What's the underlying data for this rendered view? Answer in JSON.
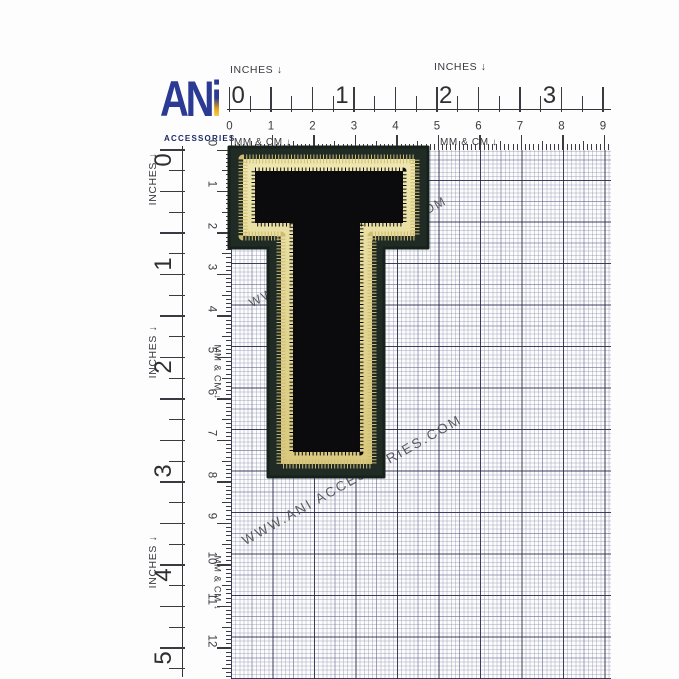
{
  "logo": {
    "an": "AN",
    "i": "i",
    "subtitle": "ACCESSORIES",
    "blue": "#2b3a92",
    "gold": "#f2b21d"
  },
  "rulers": {
    "inches_label": "INCHES ↓",
    "mmcm_label": "MM & CM ↓",
    "top": {
      "inch_numbers": [
        "0",
        "1",
        "2",
        "3"
      ],
      "cm_numbers": [
        "0",
        "1",
        "2",
        "3",
        "4",
        "5",
        "6",
        "7",
        "8",
        "9"
      ]
    },
    "left": {
      "inch_numbers": [
        "0",
        "1",
        "2",
        "3",
        "4",
        "5"
      ],
      "cm_numbers": [
        "0",
        "1",
        "2",
        "3",
        "4",
        "5",
        "6",
        "7",
        "8",
        "9",
        "10",
        "11",
        "12"
      ]
    }
  },
  "watermark": {
    "text": "WWW.ANI ACCESSORIES.COM"
  },
  "patch": {
    "letter": "T",
    "felt_color": "#202b26",
    "felt_edge_color": "#17211c",
    "gold_color": "#e7dda2",
    "gold_shade_color": "#cdbb72",
    "velvet_color": "#0b0b0d"
  }
}
